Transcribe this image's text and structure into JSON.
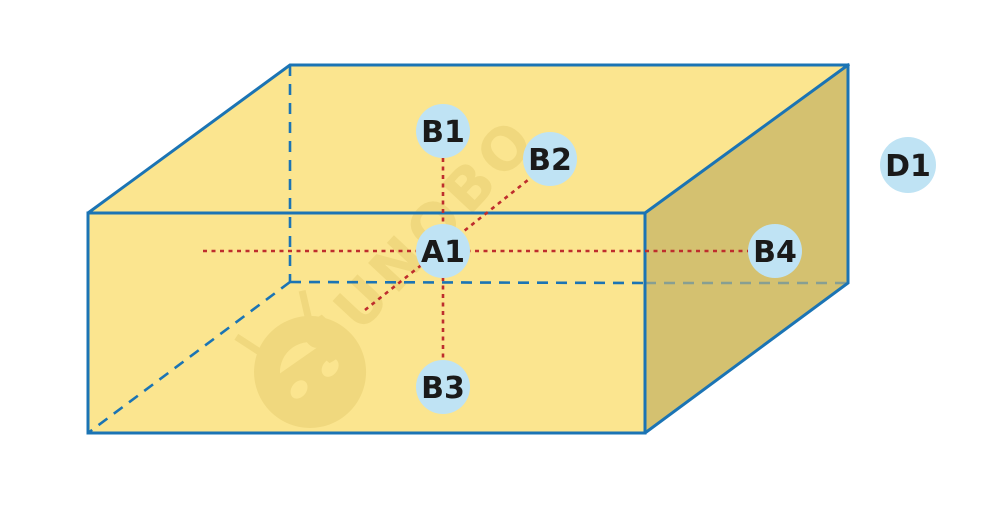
{
  "diagram": {
    "title": "3d-box-with-measurement-points",
    "nodes": [
      {
        "id": "A1",
        "label": "A1"
      },
      {
        "id": "B1",
        "label": "B1"
      },
      {
        "id": "B2",
        "label": "B2"
      },
      {
        "id": "B3",
        "label": "B3"
      },
      {
        "id": "B4",
        "label": "B4"
      },
      {
        "id": "D1",
        "label": "D1"
      }
    ],
    "watermark": {
      "text": "SUNOBO"
    }
  },
  "colors": {
    "background": "#FFFFFF",
    "face_light": "#FBE58F",
    "face_dark": "#D4C170",
    "edge_blue": "#1B74B4",
    "hidden_over_dark": "#879F92",
    "guide_red": "#BE2D2D",
    "node_fill": "#BFE3F4",
    "node_text": "#1A1A1A",
    "watermark": "#F0D87E"
  }
}
